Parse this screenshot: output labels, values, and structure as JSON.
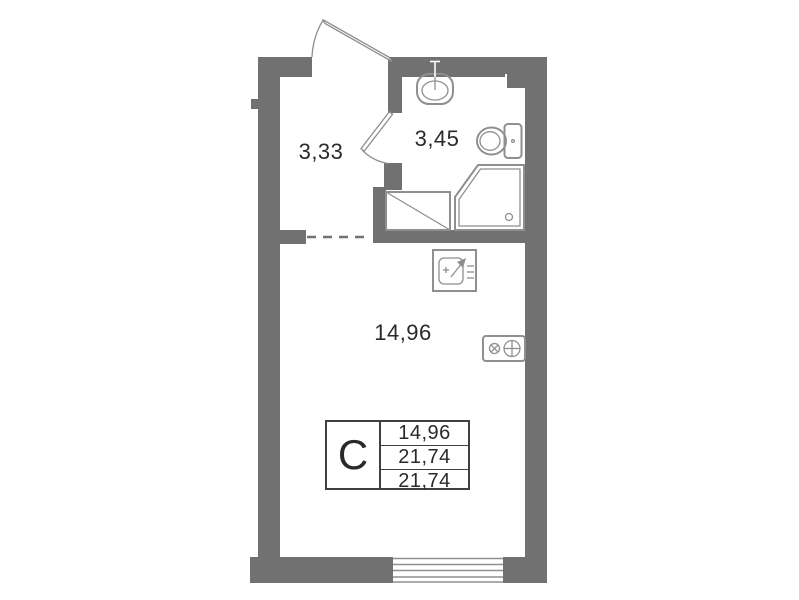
{
  "floorplan": {
    "title": "studio-apartment-floor-plan",
    "rooms": [
      {
        "name": "hallway",
        "area": "3,33"
      },
      {
        "name": "bathroom",
        "area": "3,45"
      },
      {
        "name": "living-room",
        "area": "14,96"
      }
    ],
    "info_table": {
      "type_label": "C",
      "rows": [
        {
          "value": "14,96"
        },
        {
          "value": "21,74"
        },
        {
          "value": "21,74"
        }
      ]
    },
    "fixtures": [
      "entry-door",
      "bathroom-door",
      "wash-basin",
      "toilet",
      "shower-cabin",
      "washing-machine-area",
      "kitchen-sink",
      "stove",
      "window",
      "ventilation-shaft"
    ],
    "colors": {
      "wall": "#717171",
      "line": "#8f8f8f",
      "text": "#2a2a2a",
      "tborder": "#3f3f3f"
    }
  }
}
